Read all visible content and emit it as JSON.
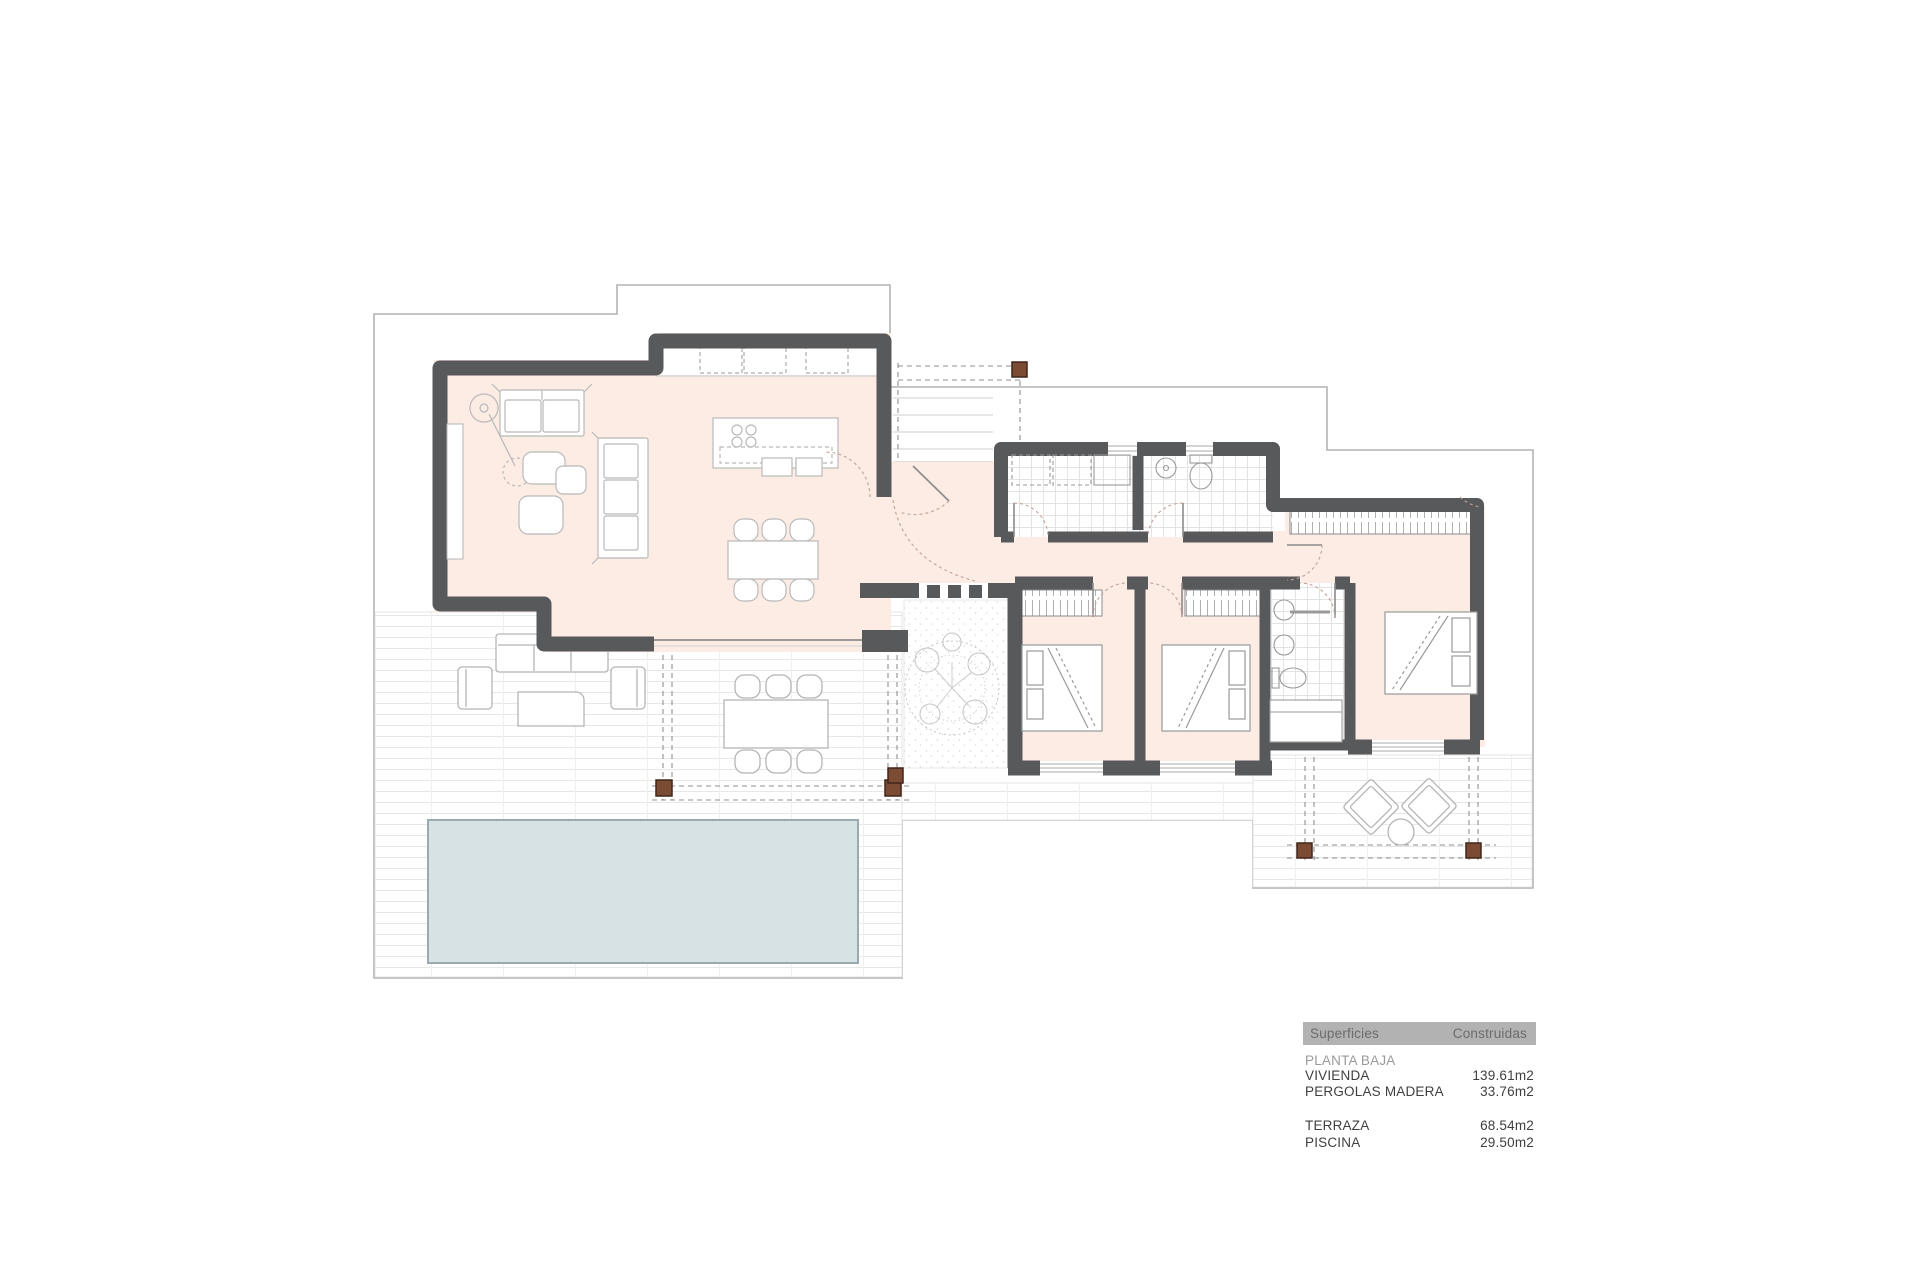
{
  "legend": {
    "col1": "Superficies",
    "col2": "Construidas",
    "section": "PLANTA BAJA",
    "rows": [
      {
        "label": "VIVIENDA",
        "value": "139.61m2"
      },
      {
        "label": "PERGOLAS MADERA",
        "value": "33.76m2"
      },
      {
        "label": "TERRAZA",
        "value": "68.54m2"
      },
      {
        "label": "PISCINA",
        "value": "29.50m2"
      }
    ]
  },
  "colors": {
    "wall": "#58595b",
    "floor": "#fcece4",
    "pool_fill": "#d6e2e4",
    "pool_border": "#9aabae",
    "pergola_post": "#7b4b33",
    "plot_boundary": "#b4b4b4",
    "paving_line": "#e7e7e7",
    "furniture_line": "#b5b5b5",
    "door_arc": "#c2a196",
    "legend_header_bg": "#b2b2b2",
    "legend_header_text": "#6c6c6c",
    "legend_section_text": "#9a9a9a",
    "legend_text": "#3f3f3f"
  },
  "icons": {
    "pool": "pool-rectangle",
    "tree": "courtyard-tree",
    "posts": "wood-pergola-posts",
    "steps": "entrance-steps"
  }
}
